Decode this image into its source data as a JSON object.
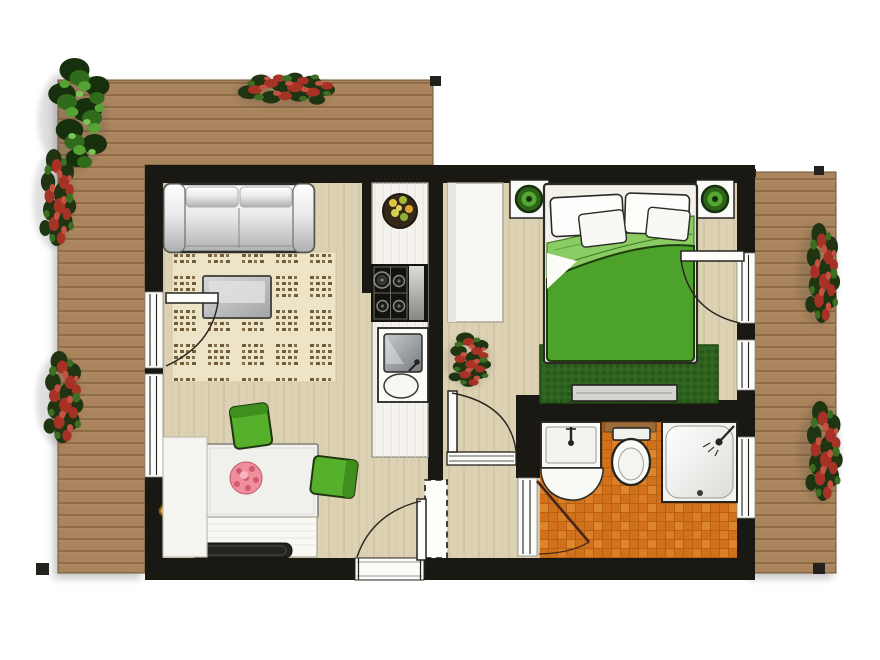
{
  "document": {
    "type": "floor-plan",
    "scene": "top-down apartment floor plan with wrap-around wooden terrace"
  },
  "colors": {
    "wall_black": "#191813",
    "deck_wood": "#a9845c",
    "deck_plank_line": "#86633f",
    "floor_wood": "#ddd1b3",
    "floor_plank_line": "#c9ba9a",
    "bathroom_tile_orange": "#d2711c",
    "tile_grout": "#b86112",
    "bed_green": "#4ca22b",
    "bed_green_light": "#8acb63",
    "bedroom_rug_green": "#2f6320",
    "chair_green": "#57b02c",
    "cushion_orange": "#e8a83c",
    "flower_pink": "#ef8f9c",
    "living_rug_beige": "#ede3c6",
    "rug_mark_brown": "#6f5c3a",
    "fixture_white": "#fbfbf9",
    "outline_dark": "#26241f",
    "closet_white": "#f7f7f4",
    "counter_white": "#f4f3ee"
  },
  "floor_plan": {
    "rooms": [
      {
        "name": "living-room",
        "items": [
          "sofa",
          "patterned-rug",
          "coffee-table",
          "dining-table",
          "dining-chair",
          "dining-chair",
          "floor-cushion-orange",
          "floor-cushion-green",
          "sideboard",
          "serving-tray",
          "window-bench",
          "balcony-door",
          "window"
        ]
      },
      {
        "name": "kitchenette",
        "items": [
          "counter",
          "fruit-bowl",
          "cooktop",
          "sink",
          "partition-wall"
        ]
      },
      {
        "name": "hall",
        "items": [
          "wardrobe",
          "potted-plant",
          "hall-door",
          "service-shaft"
        ]
      },
      {
        "name": "bedroom",
        "items": [
          "double-bed",
          "pillow",
          "pillow",
          "pillow",
          "pillow",
          "green-duvet",
          "nightstand",
          "nightstand",
          "potted-plant",
          "potted-plant",
          "dark-green-rug",
          "media-bench",
          "terrace-door",
          "window"
        ]
      },
      {
        "name": "bathroom",
        "items": [
          "washbasin",
          "vanity-front",
          "toilet",
          "wooden-shelf",
          "shower",
          "orange-tile-floor",
          "bathroom-door",
          "window"
        ]
      },
      {
        "name": "terrace",
        "items": [
          "deck-top",
          "deck-left",
          "deck-right",
          "corner-posts",
          "green-shrub",
          "red-flower-shrub",
          "red-flower-shrub",
          "red-flower-shrub",
          "red-flower-shrub",
          "red-flower-shrub"
        ]
      }
    ],
    "counts": {
      "doors": 5,
      "windows": 4,
      "exterior_shrubs": 6,
      "indoor_plants": 3
    }
  }
}
